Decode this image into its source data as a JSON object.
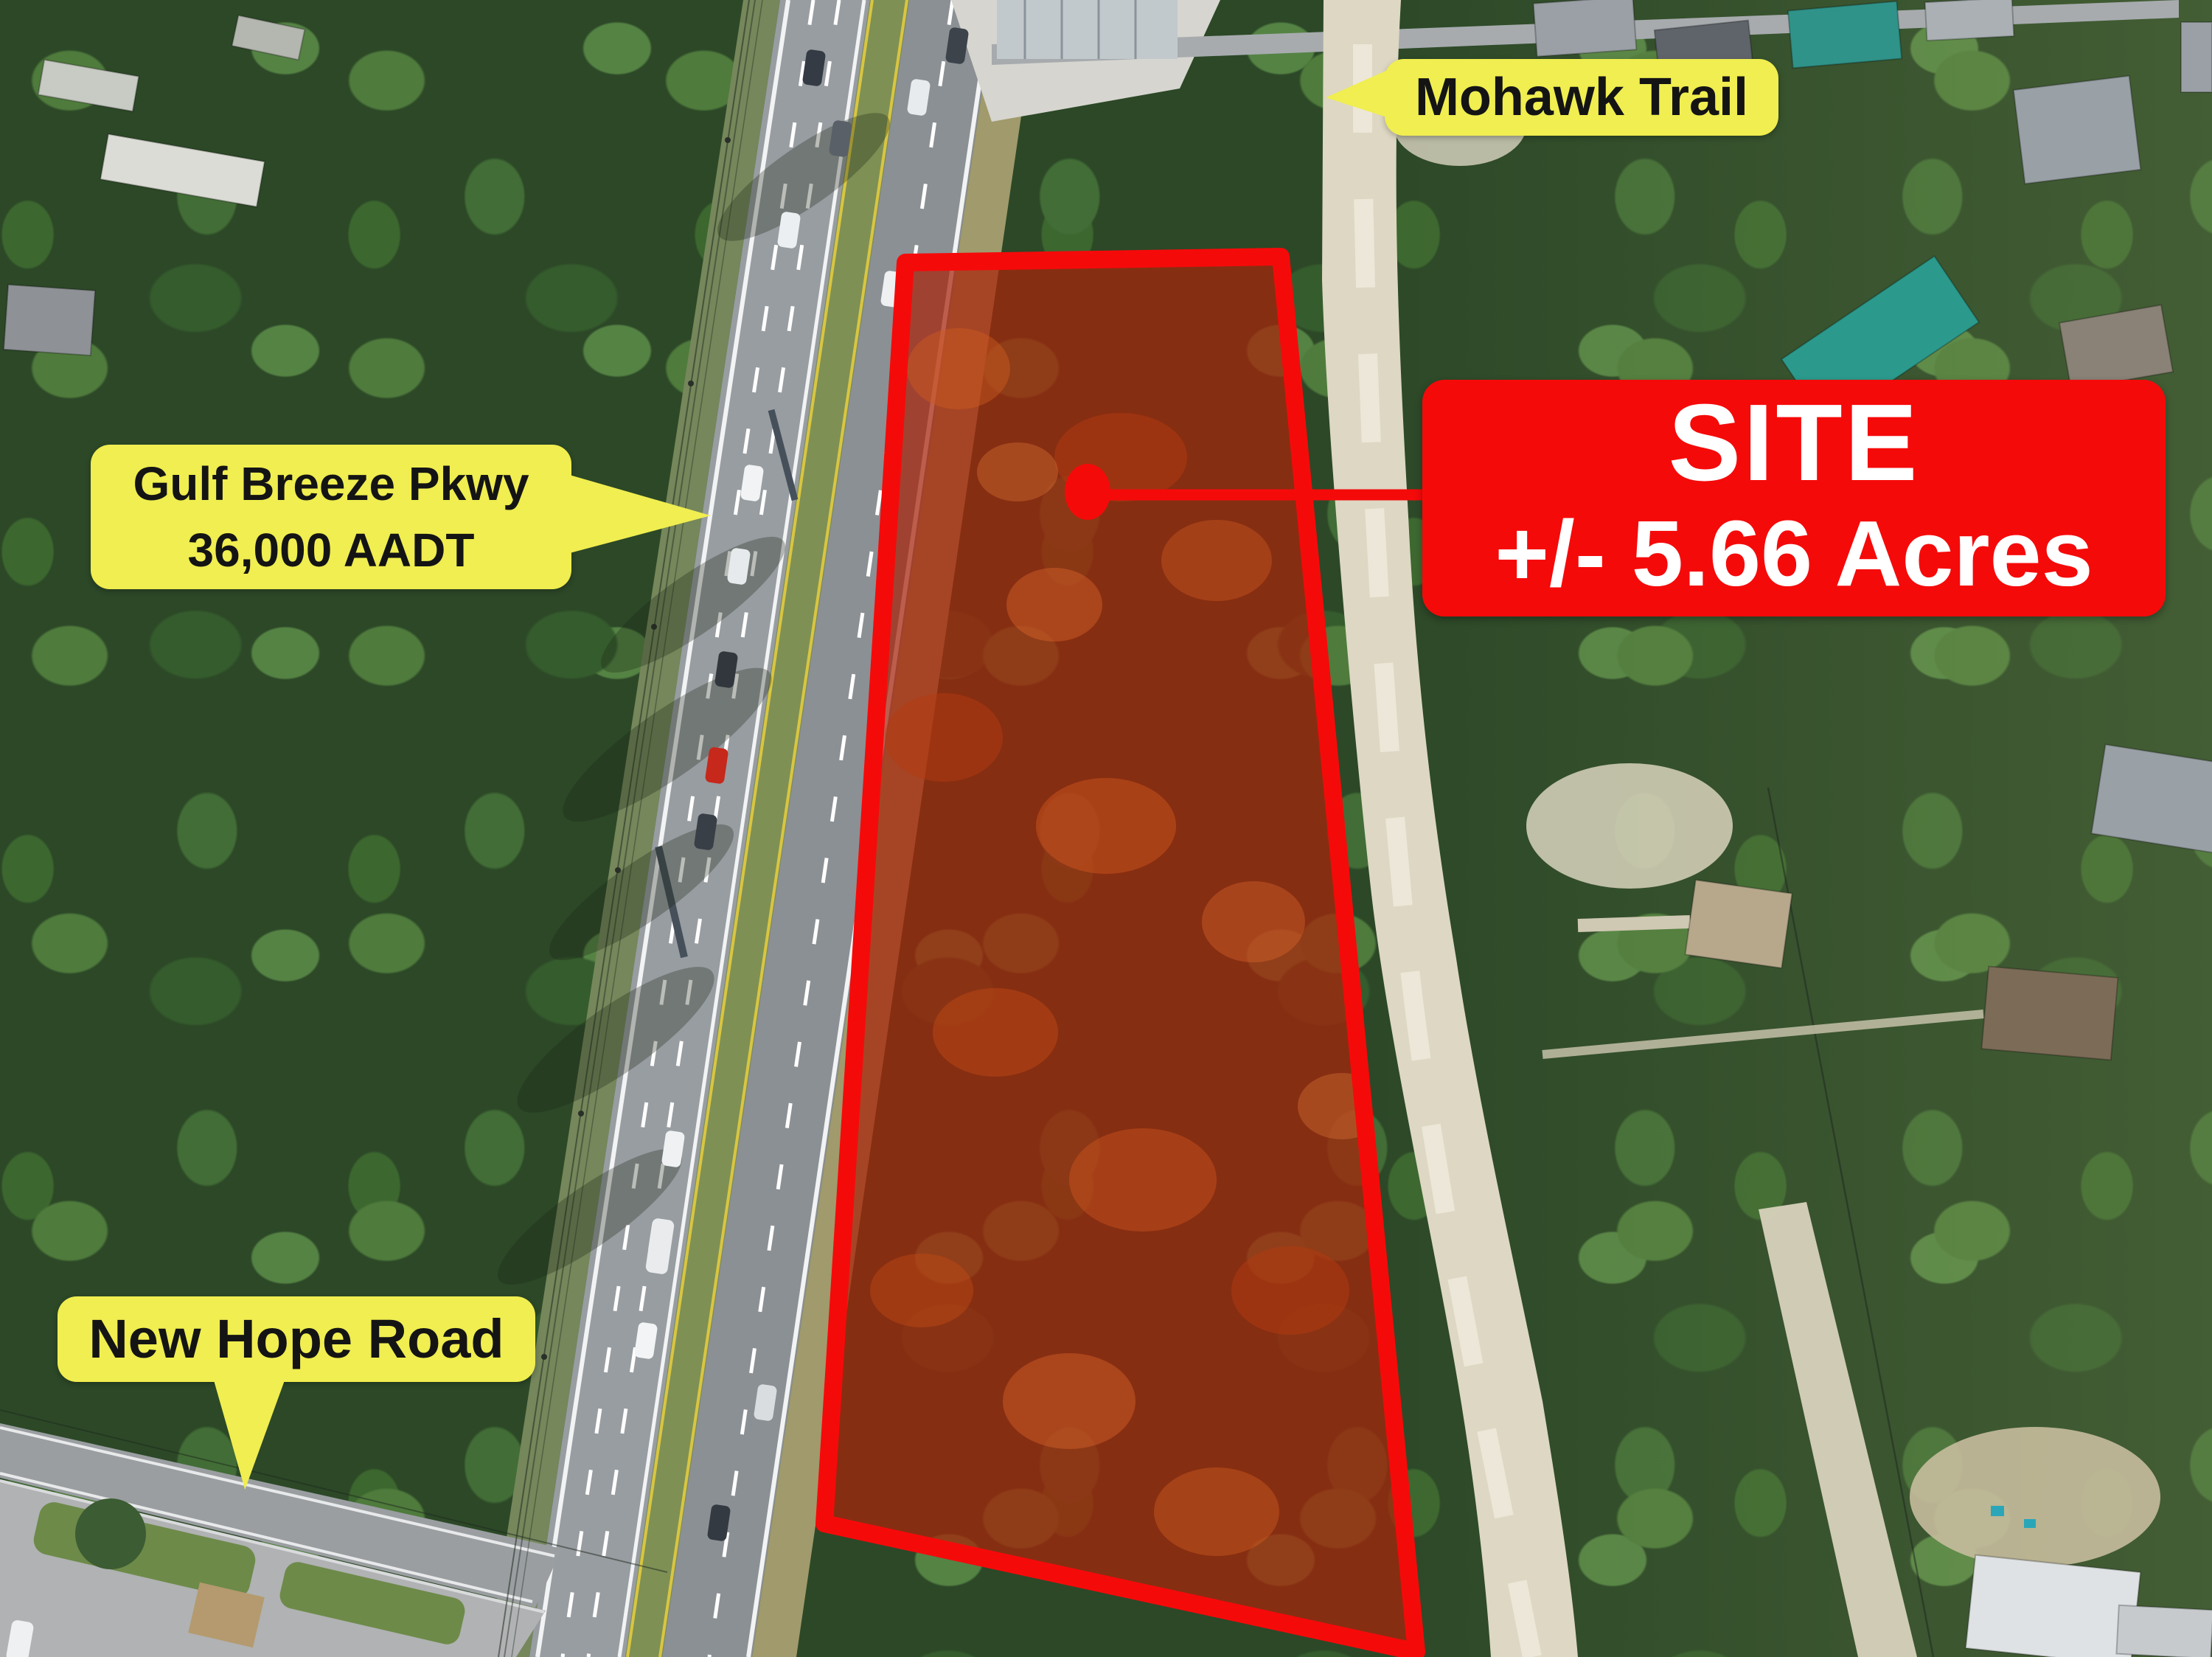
{
  "callouts": {
    "mohawk_trail": {
      "label": "Mohawk Trail"
    },
    "gulf_breeze_pkwy": {
      "line1": "Gulf Breeze Pkwy",
      "line2": "36,000 AADT"
    },
    "new_hope_road": {
      "label": "New Hope Road"
    }
  },
  "site": {
    "title": "SITE",
    "area": "+/- 5.66 Acres"
  },
  "colors": {
    "callout_yellow": "#f0ee50",
    "annotation_red": "#f50a0a",
    "callout_text": "#141414",
    "site_text": "#ffffff"
  }
}
